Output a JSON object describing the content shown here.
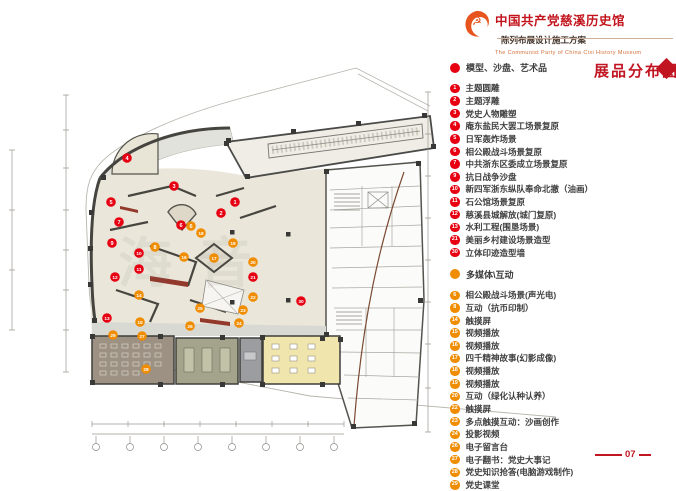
{
  "header": {
    "title": "中国共产党慈溪历史馆",
    "subtitle": "陈列布展设计施工方案",
    "english": "The Communist Party of China Cixi  History Museum",
    "logo_icon": "party-flame-emblem"
  },
  "section": {
    "title": "展品分布图"
  },
  "legend": {
    "groups": [
      {
        "name": "模型、沙盘、艺术品",
        "color": "#e60012",
        "items": [
          {
            "num": "1",
            "label": "主题圆雕"
          },
          {
            "num": "2",
            "label": "主题浮雕"
          },
          {
            "num": "3",
            "label": "党史人物雕塑"
          },
          {
            "num": "4",
            "label": "庵东盐民大罢工场景复原"
          },
          {
            "num": "5",
            "label": "日军轰炸场景"
          },
          {
            "num": "6",
            "label": "相公殿战斗场景复原"
          },
          {
            "num": "7",
            "label": "中共浙东区委成立场景复原"
          },
          {
            "num": "9",
            "label": "抗日战争沙盘"
          },
          {
            "num": "10",
            "label": "新四军浙东纵队奉命北撤（油画）"
          },
          {
            "num": "11",
            "label": "石公馆场景复原"
          },
          {
            "num": "12",
            "label": "慈溪县城解放(城门复原)"
          },
          {
            "num": "13",
            "label": "水利工程(围垦场景)"
          },
          {
            "num": "21",
            "label": "美丽乡村建设场景造型"
          },
          {
            "num": "30",
            "label": "立体印迹造型墙"
          }
        ]
      },
      {
        "name": "多媒体\\互动",
        "color": "#f08c00",
        "items": [
          {
            "num": "6",
            "label": "相公殿战斗场景(声光电)"
          },
          {
            "num": "8",
            "label": "互动（抗币印制）"
          },
          {
            "num": "14",
            "label": "触摸屏"
          },
          {
            "num": "15",
            "label": "视频播放"
          },
          {
            "num": "16",
            "label": "视频播放"
          },
          {
            "num": "17",
            "label": "四千精神故事(幻影成像)"
          },
          {
            "num": "18",
            "label": "视频播放"
          },
          {
            "num": "19",
            "label": "视频播放"
          },
          {
            "num": "20",
            "label": "互动（绿化认种认养）"
          },
          {
            "num": "22",
            "label": "触摸屏"
          },
          {
            "num": "23",
            "label": "多点触摸互动：沙画创作"
          },
          {
            "num": "24",
            "label": "投影视频"
          },
          {
            "num": "26",
            "label": "电子留言台"
          },
          {
            "num": "27",
            "label": "电子翻书：党史大事记"
          },
          {
            "num": "28",
            "label": "党史知识抢答(电脑游戏制作)"
          },
          {
            "num": "29",
            "label": "党史课堂"
          }
        ]
      }
    ]
  },
  "plan": {
    "watermark": "海音",
    "marker_colors": {
      "red": "#e60012",
      "orange": "#f08c00"
    },
    "markers": [
      {
        "n": "4",
        "c": "red",
        "x": 127,
        "y": 158
      },
      {
        "n": "3",
        "c": "red",
        "x": 174,
        "y": 186
      },
      {
        "n": "5",
        "c": "red",
        "x": 111,
        "y": 202
      },
      {
        "n": "1",
        "c": "red",
        "x": 235,
        "y": 202
      },
      {
        "n": "2",
        "c": "red",
        "x": 221,
        "y": 213
      },
      {
        "n": "6",
        "c": "red",
        "x": 181,
        "y": 225
      },
      {
        "n": "6",
        "c": "orange",
        "x": 191,
        "y": 226
      },
      {
        "n": "7",
        "c": "red",
        "x": 119,
        "y": 222
      },
      {
        "n": "18",
        "c": "orange",
        "x": 201,
        "y": 233
      },
      {
        "n": "19",
        "c": "orange",
        "x": 233,
        "y": 243
      },
      {
        "n": "9",
        "c": "red",
        "x": 112,
        "y": 243
      },
      {
        "n": "8",
        "c": "orange",
        "x": 155,
        "y": 247
      },
      {
        "n": "10",
        "c": "red",
        "x": 139,
        "y": 253
      },
      {
        "n": "16",
        "c": "orange",
        "x": 184,
        "y": 257
      },
      {
        "n": "17",
        "c": "orange",
        "x": 214,
        "y": 258
      },
      {
        "n": "20",
        "c": "orange",
        "x": 253,
        "y": 262
      },
      {
        "n": "11",
        "c": "red",
        "x": 139,
        "y": 269
      },
      {
        "n": "12",
        "c": "red",
        "x": 115,
        "y": 277
      },
      {
        "n": "21",
        "c": "red",
        "x": 253,
        "y": 277
      },
      {
        "n": "14",
        "c": "orange",
        "x": 139,
        "y": 295
      },
      {
        "n": "22",
        "c": "orange",
        "x": 253,
        "y": 297
      },
      {
        "n": "25",
        "c": "orange",
        "x": 200,
        "y": 308
      },
      {
        "n": "23",
        "c": "orange",
        "x": 243,
        "y": 310
      },
      {
        "n": "30",
        "c": "red",
        "x": 301,
        "y": 301
      },
      {
        "n": "13",
        "c": "red",
        "x": 107,
        "y": 318
      },
      {
        "n": "15",
        "c": "orange",
        "x": 140,
        "y": 322
      },
      {
        "n": "24",
        "c": "orange",
        "x": 239,
        "y": 323
      },
      {
        "n": "26",
        "c": "orange",
        "x": 190,
        "y": 326
      },
      {
        "n": "27",
        "c": "orange",
        "x": 142,
        "y": 336
      },
      {
        "n": "29",
        "c": "orange",
        "x": 113,
        "y": 335
      },
      {
        "n": "28",
        "c": "orange",
        "x": 146,
        "y": 369
      }
    ]
  },
  "footer": {
    "page": "07"
  },
  "accent_color": "#c11622"
}
